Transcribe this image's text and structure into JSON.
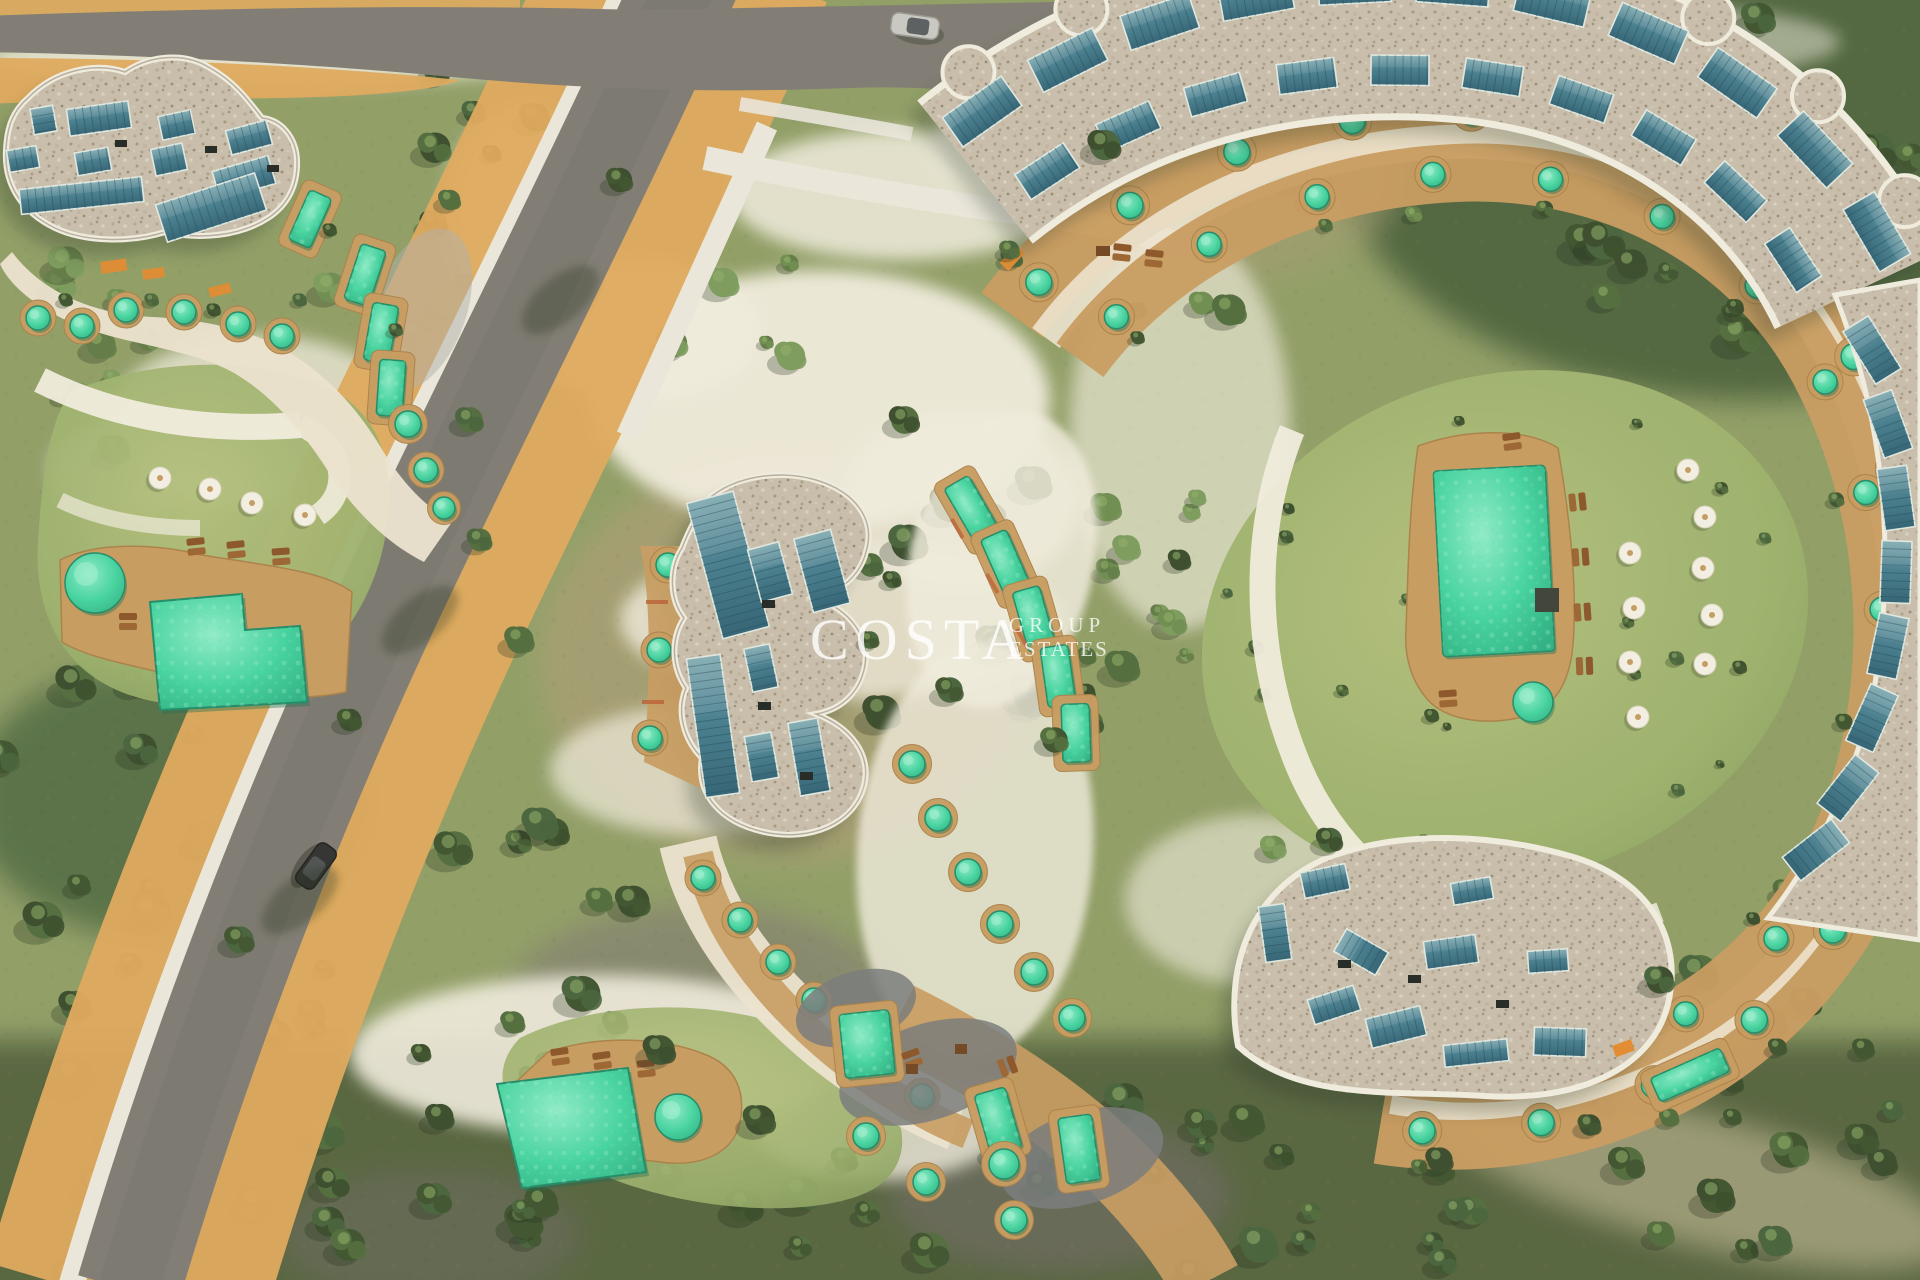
{
  "watermark": {
    "brand": "COSTA",
    "group_label": "GROUP",
    "estates_label": "ESTATES"
  },
  "scene": {
    "description": "Aerial 3D architectural rendering of a curved resort-style apartment development with gravel roofs, rooftop solar panels, terraced units with private plunge pools, communal gardens and pools, winding roads and Mediterranean vegetation",
    "buildings": [
      {
        "name": "north-west curved block",
        "features": "wavy gravel roof with solar panels, terraces with plunge pools"
      },
      {
        "name": "central S-shaped block",
        "features": "gravel roof with solar panels, stepped terraces with round plunge pools"
      },
      {
        "name": "east C-shaped block",
        "features": "large arc roof with rows of solar panels enclosing an oval communal garden"
      }
    ],
    "amenities": [
      {
        "name": "west communal pool garden",
        "features": "L-shaped pool, round spa pool, sun loungers, parasols"
      },
      {
        "name": "south-west communal pool area",
        "features": "angular pool, round spa pool, sun loungers"
      },
      {
        "name": "central oval garden",
        "features": "rectangular pool on deck, parasols, loungers, round spa pool"
      }
    ],
    "vehicles": [
      {
        "name": "silver car",
        "location": "top road"
      },
      {
        "name": "dark car",
        "location": "west road"
      }
    ]
  },
  "palette": {
    "vegetation_base": "#8e9d66",
    "lawn_green": "#a6b375",
    "tree_dark": "#3f5531",
    "tree_mid": "#5d7844",
    "scrub_khaki": "#a49b73",
    "sand_white": "#f1ede0",
    "path_sand": "#dfa85c",
    "road_asphalt": "#7d7a73",
    "sidewalk_white": "#eae7de",
    "roof_gravel": "#c8bdac",
    "roof_rim": "#f0ece1",
    "solar_panel": "#3f7488",
    "pool_teal": "#3fd3a0",
    "deck_tan": "#c79a5f",
    "terracotta": "#b85c31",
    "awning_orange": "#e2892e",
    "umbrella_white": "#f3f0e6",
    "lounger_brown": "#8a5227",
    "car_dark": "#2d2e2f",
    "car_silver": "#c9c8c4",
    "watermark_white": "#ffffff"
  }
}
